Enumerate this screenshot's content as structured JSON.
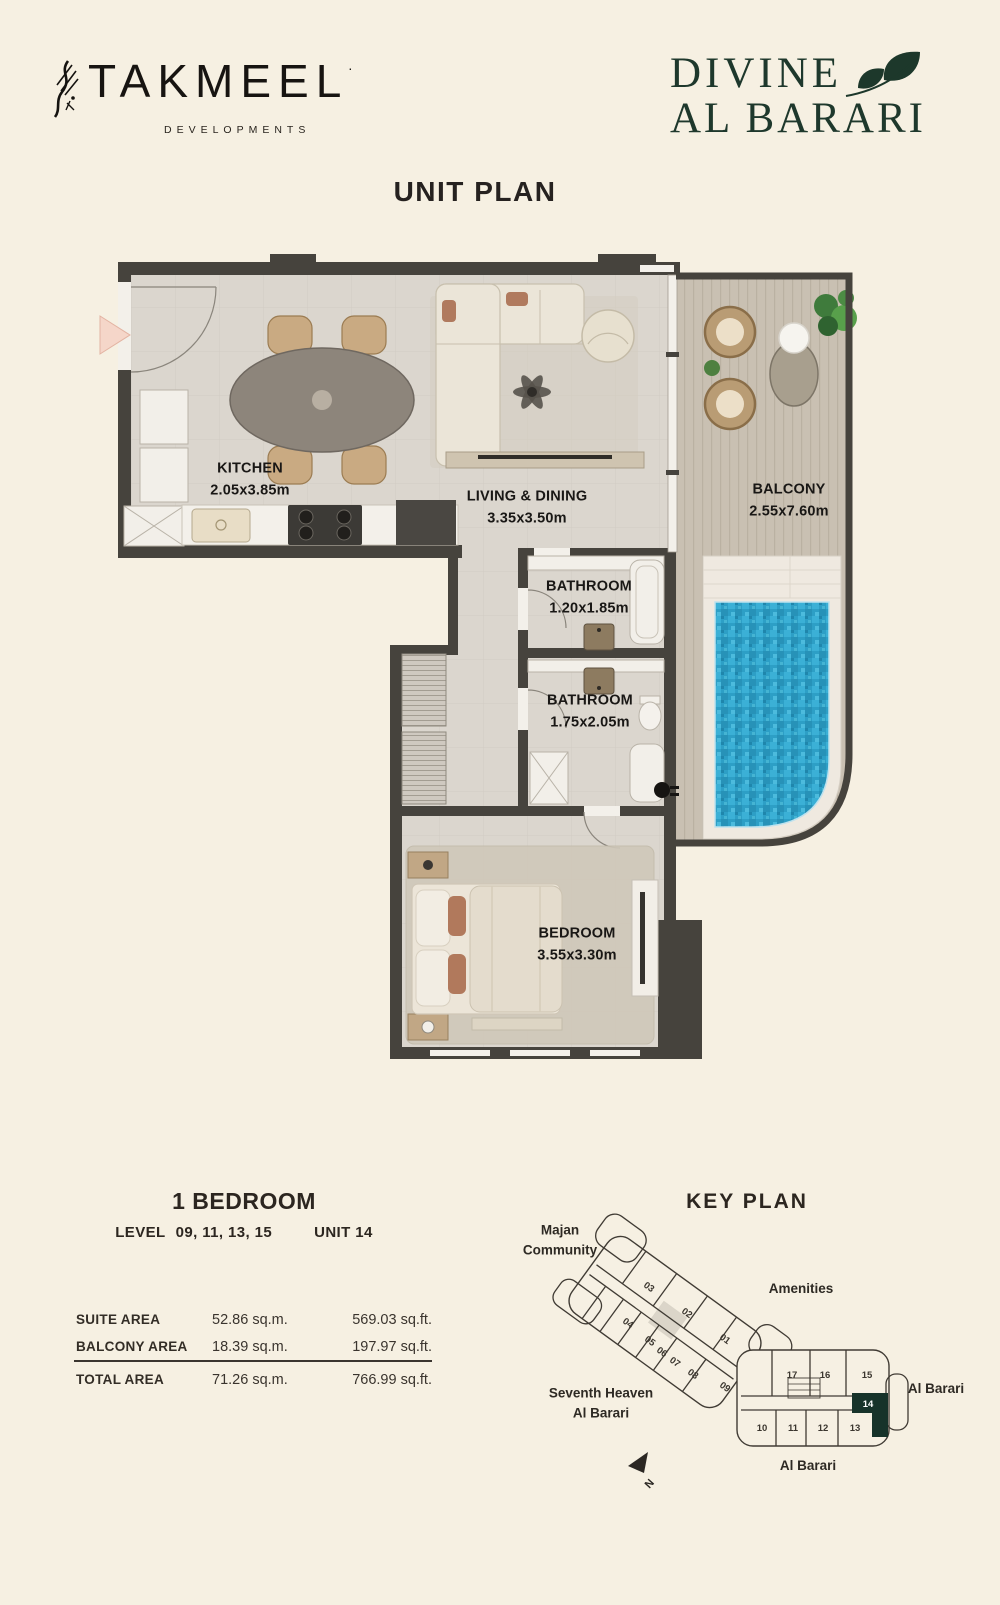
{
  "brand": {
    "takmeel_name": "TAKMEEL",
    "takmeel_mark": ".",
    "takmeel_sub": "DEVELOPMENTS",
    "divine_line1": "DIVINE",
    "divine_line2": "AL BARARI"
  },
  "page_title": "UNIT PLAN",
  "floor_plan": {
    "rooms": [
      {
        "name": "KITCHEN",
        "dims": "2.05x3.85m"
      },
      {
        "name": "LIVING & DINING",
        "dims": "3.35x3.50m"
      },
      {
        "name": "BALCONY",
        "dims": "2.55x7.60m"
      },
      {
        "name": "BATHROOM",
        "dims": "1.20x1.85m"
      },
      {
        "name": "BATHROOM",
        "dims": "1.75x2.05m"
      },
      {
        "name": "BEDROOM",
        "dims": "3.55x3.30m"
      }
    ]
  },
  "unit_info": {
    "type": "1 BEDROOM",
    "level_label": "LEVEL",
    "levels": "09, 11, 13, 15",
    "unit": "UNIT 14",
    "areas": [
      {
        "label": "SUITE AREA",
        "sqm": "52.86 sq.m.",
        "sqft": "569.03 sq.ft."
      },
      {
        "label": "BALCONY AREA",
        "sqm": "18.39 sq.m.",
        "sqft": "197.97 sq.ft."
      },
      {
        "label": "TOTAL AREA",
        "sqm": "71.26 sq.m.",
        "sqft": "766.99 sq.ft."
      }
    ]
  },
  "key_plan": {
    "title": "KEY PLAN",
    "labels": {
      "majan_1": "Majan",
      "majan_2": "Community",
      "amenities": "Amenities",
      "seventh_1": "Seventh Heaven",
      "seventh_2": "Al Barari",
      "al_barari_right": "Al Barari",
      "al_barari_bottom": "Al Barari",
      "north": "N"
    },
    "highlighted_unit": "14",
    "left_wing_units": [
      "01",
      "02",
      "03",
      "04",
      "05",
      "06",
      "07",
      "08",
      "09"
    ],
    "right_wing_top_units": [
      "17",
      "16",
      "15"
    ],
    "right_wing_bottom_units": [
      "10",
      "11",
      "12",
      "13"
    ]
  },
  "colors": {
    "background": "#f6f0e2",
    "wall": "#46433d",
    "accent_green": "#1d382b",
    "pool_blue": "#2d9fc6",
    "highlight_unit": "#17332a"
  }
}
